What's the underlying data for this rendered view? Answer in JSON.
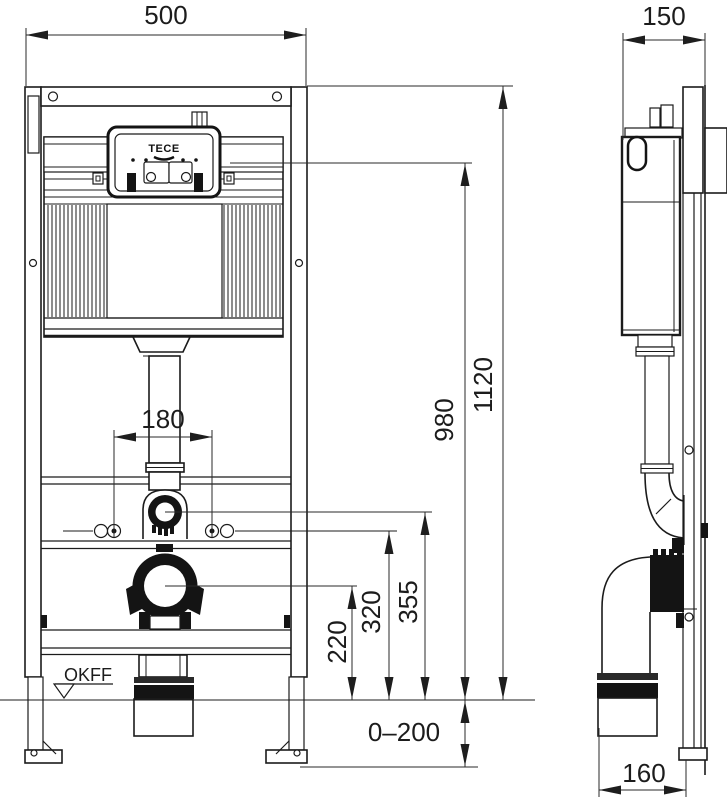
{
  "drawing": {
    "logo": "TECE",
    "floor_marker": "OKFF",
    "dims": {
      "frame_width": "500",
      "frame_depth": "150",
      "frame_height": "1120",
      "actuator_height": "980",
      "flush_bend_height": "355",
      "fixing_height": "320",
      "drain_height": "220",
      "fixing_spacing": "180",
      "foot_adjustment": "0–200",
      "drain_offset": "160"
    }
  }
}
